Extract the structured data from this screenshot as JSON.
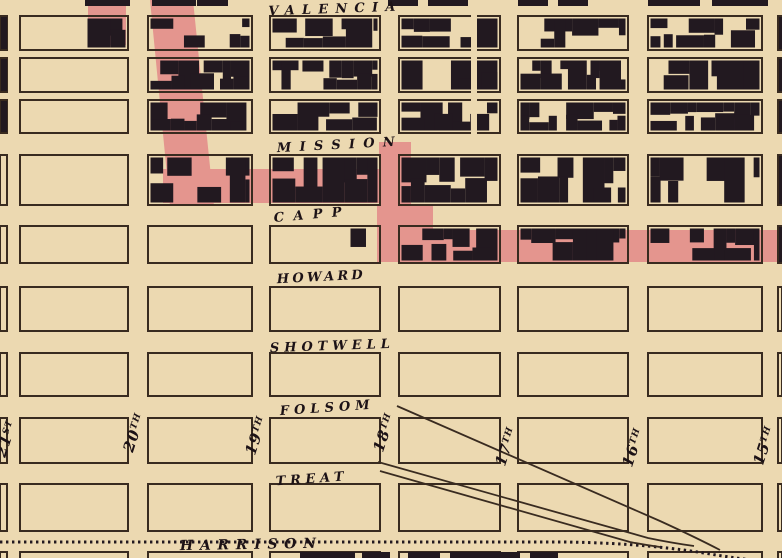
{
  "colors": {
    "background": "#ecd9b1",
    "block_line": "#392b20",
    "building_ink": "#221920",
    "text_ink": "#1c1216",
    "burnt_overlay_pink": "#e4958e"
  },
  "map": {
    "width": 782,
    "height": 558,
    "horizontal_streets": [
      {
        "id": "valencia",
        "label": "VALENCIA",
        "gap": [
          6,
          16
        ],
        "label_x": 332,
        "label_y": 13,
        "length": 127,
        "angle": -2,
        "font": 13
      },
      {
        "id": "mission",
        "label": "MISSION",
        "gap": [
          133,
          155
        ],
        "label_x": 336,
        "label_y": 149,
        "length": 118,
        "angle": -3,
        "font": 13
      },
      {
        "id": "capp",
        "label": "CAPP",
        "gap": [
          205,
          226
        ],
        "label_x": 308,
        "label_y": 219,
        "length": 68,
        "angle": -5,
        "font": 13
      },
      {
        "id": "howard",
        "label": "HOWARD",
        "gap": [
          263,
          287
        ],
        "label_x": 320,
        "label_y": 281,
        "length": 86,
        "angle": -3,
        "font": 13
      },
      {
        "id": "shotwell",
        "label": "SHOTWELL",
        "gap": [
          331,
          353
        ],
        "label_x": 330,
        "label_y": 350,
        "length": 120,
        "angle": -2,
        "font": 13
      },
      {
        "id": "folsom",
        "label": "FOLSOM",
        "gap": [
          396,
          418
        ],
        "label_x": 325,
        "label_y": 412,
        "length": 90,
        "angle": -4,
        "font": 13
      },
      {
        "id": "treat",
        "label": "TREAT",
        "gap": [
          463,
          484
        ],
        "label_x": 310,
        "label_y": 483,
        "length": 68,
        "angle": -4,
        "font": 13
      },
      {
        "id": "harrison",
        "label": "HARRISON",
        "gap": [
          531,
          552
        ],
        "label_x": 248,
        "label_y": 549,
        "length": 136,
        "angle": -1,
        "font": 14
      }
    ],
    "vertical_streets": [
      {
        "id": "21st",
        "label": "21",
        "suffix": "ST",
        "cx": 11,
        "cy": 440
      },
      {
        "id": "20th",
        "label": "20",
        "suffix": "TH",
        "cx": 139,
        "cy": 434
      },
      {
        "id": "19th",
        "label": "19",
        "suffix": "TH",
        "cx": 261,
        "cy": 437
      },
      {
        "id": "18th",
        "label": "18",
        "suffix": "TH",
        "cx": 389,
        "cy": 434
      },
      {
        "id": "17th",
        "label": "17",
        "suffix": "TH",
        "cx": 511,
        "cy": 448
      },
      {
        "id": "16th",
        "label": "16",
        "suffix": "TH",
        "cx": 638,
        "cy": 449
      },
      {
        "id": "15th",
        "label": "15",
        "suffix": "TH",
        "cx": 769,
        "cy": 447
      }
    ],
    "vertical_label_angle": -72,
    "grid": {
      "cols": [
        [
          0,
          7
        ],
        [
          20,
          128
        ],
        [
          148,
          252
        ],
        [
          270,
          380
        ],
        [
          399,
          500
        ],
        [
          518,
          628
        ],
        [
          648,
          762
        ],
        [
          778,
          782
        ]
      ],
      "rows": [
        [
          16,
          50
        ],
        [
          58,
          92
        ],
        [
          100,
          133
        ],
        [
          155,
          205
        ],
        [
          226,
          263
        ],
        [
          287,
          331
        ],
        [
          353,
          396
        ],
        [
          418,
          463
        ],
        [
          484,
          531
        ],
        [
          552,
          564
        ]
      ]
    },
    "built_blocks": [
      [
        0,
        16,
        7,
        50
      ],
      [
        85,
        16,
        128,
        50
      ],
      [
        148,
        16,
        252,
        50
      ],
      [
        270,
        16,
        380,
        50
      ],
      [
        399,
        16,
        500,
        50
      ],
      [
        518,
        16,
        628,
        50
      ],
      [
        648,
        16,
        762,
        50
      ],
      [
        778,
        16,
        782,
        50
      ],
      [
        0,
        58,
        7,
        92
      ],
      [
        148,
        58,
        252,
        92
      ],
      [
        270,
        58,
        380,
        92
      ],
      [
        399,
        58,
        500,
        92
      ],
      [
        518,
        58,
        628,
        92
      ],
      [
        648,
        58,
        762,
        92
      ],
      [
        778,
        58,
        782,
        92
      ],
      [
        0,
        100,
        7,
        133
      ],
      [
        148,
        100,
        252,
        133
      ],
      [
        270,
        100,
        380,
        133
      ],
      [
        399,
        100,
        500,
        133
      ],
      [
        518,
        100,
        628,
        133
      ],
      [
        648,
        100,
        762,
        133
      ],
      [
        778,
        100,
        782,
        133
      ],
      [
        148,
        155,
        252,
        205
      ],
      [
        270,
        155,
        380,
        205
      ],
      [
        399,
        155,
        500,
        205
      ],
      [
        518,
        155,
        628,
        205
      ],
      [
        648,
        155,
        762,
        205
      ],
      [
        778,
        155,
        782,
        205
      ],
      [
        348,
        226,
        380,
        263
      ],
      [
        399,
        226,
        500,
        263
      ],
      [
        518,
        226,
        628,
        263
      ],
      [
        648,
        226,
        762,
        263
      ],
      [
        778,
        226,
        782,
        263
      ]
    ],
    "alley_clear": [
      471,
      14,
      6,
      121
    ],
    "top_sliver_segments": [
      [
        85,
        130
      ],
      [
        152,
        196
      ],
      [
        197,
        228
      ],
      [
        388,
        418
      ],
      [
        428,
        468
      ],
      [
        518,
        548
      ],
      [
        558,
        588
      ],
      [
        648,
        700
      ],
      [
        712,
        768
      ]
    ],
    "bottom_building_bars": [
      [
        300,
        552,
        55
      ],
      [
        362,
        552,
        28
      ],
      [
        408,
        552,
        32
      ],
      [
        450,
        552,
        70
      ],
      [
        530,
        552,
        28
      ]
    ],
    "burnt_overlay": {
      "polygons": [
        [
          [
            150,
            0
          ],
          [
            193,
            0
          ],
          [
            214,
            206
          ],
          [
            170,
            206
          ]
        ]
      ],
      "rects": [
        [
          88,
          5,
          38,
          40
        ],
        [
          163,
          169,
          233,
          34
        ],
        [
          379,
          142,
          32,
          66
        ],
        [
          377,
          206,
          56,
          30
        ],
        [
          377,
          230,
          405,
          32
        ]
      ]
    },
    "railroad": {
      "harrison_dotted": "M 0 542 L 566 542 C 630 543 676 548 716 555 C 736 558 756 561 782 563",
      "spur_lines": [
        "M 378 462 L 648 538 Q 672 543 694 546",
        "M 380 471 L 630 542 Q 645 545 660 547",
        "M 397 406 L 660 521 Q 695 537 720 550"
      ]
    },
    "building_seed": 7
  }
}
